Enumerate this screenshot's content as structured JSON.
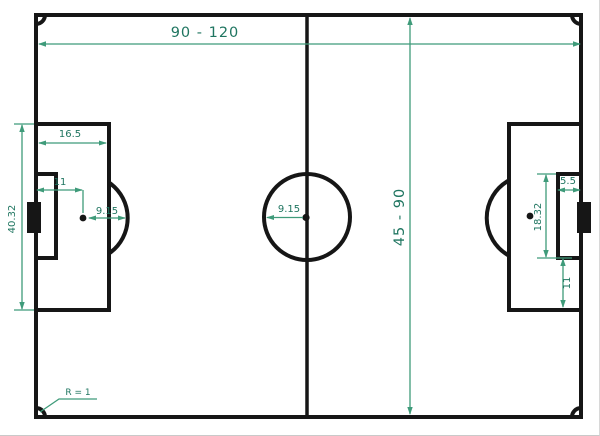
{
  "diagram": {
    "type": "football-pitch-dimensions",
    "colors": {
      "pitch_line": "#161616",
      "dimension_line": "#3f9b7a",
      "dimension_text": "#1f7560",
      "background": "#ffffff"
    },
    "dimensions": {
      "pitch_length": "90 - 120",
      "pitch_width": "45 - 90",
      "penalty_area_depth": "16.5",
      "penalty_area_width": "40.32",
      "penalty_spot_distance": "11",
      "penalty_arc_radius": "9.15",
      "centre_circle_radius": "9.15",
      "goal_area_depth": "5.5",
      "goal_area_width": "18.32",
      "goal_area_to_penalty_area": "11",
      "corner_arc_radius": "R = 1"
    }
  }
}
